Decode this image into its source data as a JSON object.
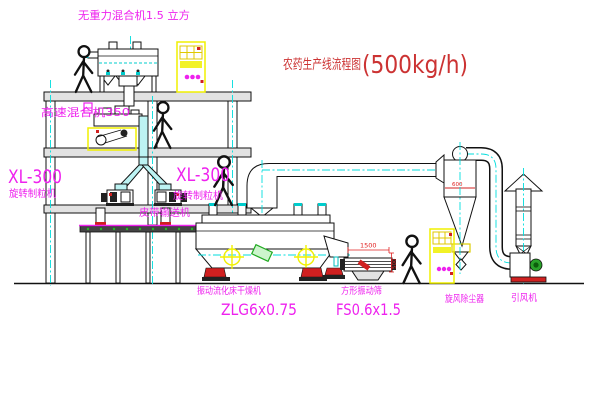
{
  "title": {
    "text": "农药生产线流程图",
    "capacity": "(500kg/h)"
  },
  "equipment": {
    "gravity_free_mixer": {
      "label": "无重力混合机1.5 立方"
    },
    "high_speed_mixer": {
      "label": "高速混合机350"
    },
    "granulator_left": {
      "model": "XL-300",
      "name": "旋转制粒机"
    },
    "granulator_right": {
      "model": "XL-300",
      "name": "旋转制粒机"
    },
    "belt_conveyor": {
      "label": "皮带输送机"
    },
    "fluidized_bed_dryer": {
      "name": "振动流化床干燥机",
      "model": "ZLG6x0.75"
    },
    "vibrating_screen": {
      "name": "方形振动筛",
      "model": "FS0.6x1.5"
    },
    "cyclone_dust_collector": {
      "label": "旋风除尘器"
    },
    "induced_draft_fan": {
      "label": "引风机"
    }
  },
  "dimensions": {
    "screen_length": "1500",
    "screen_height": "500",
    "cyclone_diameter": "600"
  },
  "colors": {
    "label_magenta": "#ee22ee",
    "title_red": "#cc3333",
    "centerline_cyan": "#00dddd",
    "highlight_yellow": "#f0f000",
    "accent_red": "#d02020",
    "motor_green": "#22aa22",
    "chute_cyan": "#bdf3f3"
  }
}
